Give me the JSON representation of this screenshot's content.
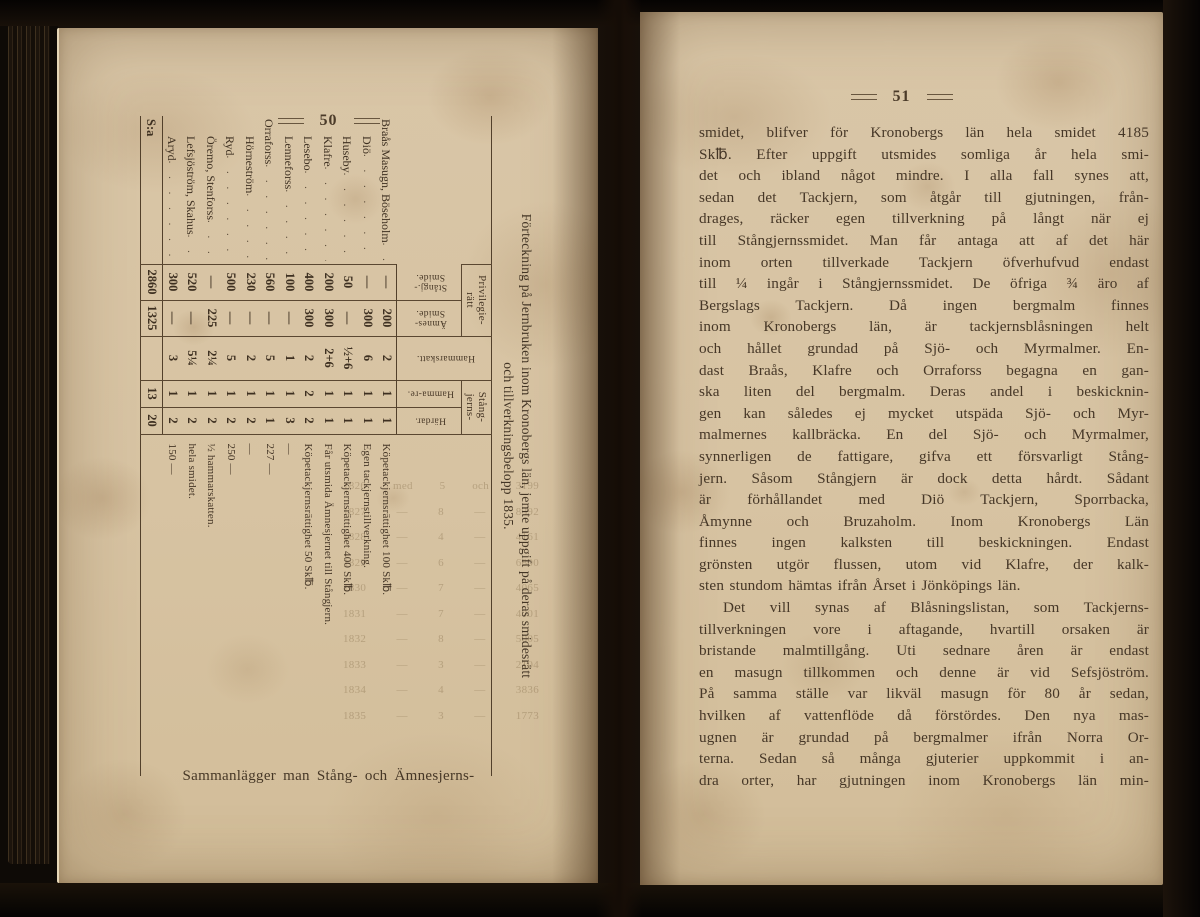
{
  "colors": {
    "paper": "#d8c5a4",
    "ink": "#463727",
    "background_dark": "#0d0906"
  },
  "left_page": {
    "page_number": "50",
    "table": {
      "title_line1": "Förteckning på Jernbruken inom Kronobergs län, jemte uppgift på deras smidesrätt",
      "title_line2": "och tillverkningsbelopp 1835.",
      "group_headers": {
        "privilegieratt": "Privilegie-rätt",
        "stangjerns": "Stång-jerns-"
      },
      "column_headers": {
        "stangj_smide": "Stångj.-Smide.",
        "amnes_smide": "Ämnes-Smide.",
        "hammarskatt": "Hammarskatt.",
        "hammare": "Hamma-re.",
        "hardar": "Härdar."
      },
      "rows": [
        {
          "name": "Braås Masugn, Böseholm",
          "indent": false,
          "stangj": "—",
          "amnes": "200",
          "skatt": "2",
          "hammare": "1",
          "hardar": "1",
          "note": "Köpetackjernsrättighet 100 Sk℔."
        },
        {
          "name": "Diö",
          "indent": true,
          "stangj": "—",
          "amnes": "300",
          "skatt": "6",
          "hammare": "1",
          "hardar": "1",
          "note": "Egen tackjernstillverkning."
        },
        {
          "name": "Huseby",
          "indent": true,
          "stangj": "50",
          "amnes": "—",
          "skatt": "½+6",
          "hammare": "1",
          "hardar": "1",
          "note": "Köpetackjernsrättighet 400 Sk℔."
        },
        {
          "name": "Klafre",
          "indent": true,
          "stangj": "200",
          "amnes": "300",
          "skatt": "2+6",
          "hammare": "1",
          "hardar": "1",
          "note": "Får utsmida Ämnesjernet till Stångjern."
        },
        {
          "name": "Lesebo",
          "indent": true,
          "stangj": "400",
          "amnes": "300",
          "skatt": "2",
          "hammare": "2",
          "hardar": "2",
          "note": "Köpetackjernsrättighet 50 Sk℔."
        },
        {
          "name": "Lenneforss",
          "indent": true,
          "stangj": "100",
          "amnes": "—",
          "skatt": "1",
          "hammare": "1",
          "hardar": "3",
          "note": "—"
        },
        {
          "name": "Orraforss",
          "indent": false,
          "stangj": "560",
          "amnes": "—",
          "skatt": "5",
          "hammare": "1",
          "hardar": "1",
          "note": "227 —"
        },
        {
          "name": "Hörneström",
          "indent": true,
          "stangj": "230",
          "amnes": "—",
          "skatt": "2",
          "hammare": "1",
          "hardar": "2",
          "note": "—"
        },
        {
          "name": "Ryd",
          "indent": true,
          "stangj": "500",
          "amnes": "—",
          "skatt": "5",
          "hammare": "1",
          "hardar": "2",
          "note": "250 —"
        },
        {
          "name": "Öremo, Stenforss",
          "indent": true,
          "stangj": "—",
          "amnes": "225",
          "skatt": "2¼",
          "hammare": "1",
          "hardar": "2",
          "note": "½ hammarskatten."
        },
        {
          "name": "Lefsjöström, Skahus",
          "indent": true,
          "stangj": "520",
          "amnes": "—",
          "skatt": "5¼",
          "hammare": "1",
          "hardar": "2",
          "note": "hela smidet."
        },
        {
          "name": "Aryd",
          "indent": true,
          "stangj": "300",
          "amnes": "—",
          "skatt": "3",
          "hammare": "1",
          "hardar": "2",
          "note": "150 —"
        },
        {
          "name": "S:a",
          "indent": false,
          "sum": true,
          "stangj": "2860",
          "amnes": "1325",
          "skatt": "",
          "hammare": "13",
          "hardar": "20",
          "note": ""
        }
      ]
    },
    "bleedthrough": [
      "1826 med 5 och 3199",
      "1827 — 8 — 8392",
      "1828 — 4 — 4161",
      "1829 — 6 — 6800",
      "1830 — 7 — 4065",
      "1831 — 7 — 4001",
      "1832 — 8 — 5005",
      "1833 — 3 — 2104",
      "1834 — 4 — 3836",
      "1835 — 3 — 1773"
    ],
    "caption": "Sammanlägger man Stång- och Ämnesjerns-"
  },
  "right_page": {
    "page_number": "51",
    "paragraph1_lines": [
      "smidet, blifver för Kronobergs län hela smidet 4185",
      "Sk℔. Efter uppgift utsmides somliga år hela smi-",
      "det och ibland något mindre. I alla fall synes att,",
      "sedan det Tackjern, som åtgår till gjutningen, från-",
      "drages, räcker egen tillverkning på långt när ej",
      "till Stångjernssmidet. Man får antaga att af det här",
      "inom orten tillverkade Tackjern öfverhufvud endast",
      "till ¼ ingår i Stångjernssmidet. De öfriga ¾ äro af",
      "Bergslags Tackjern. Då ingen bergmalm finnes",
      "inom Kronobergs län, är tackjernsblåsningen helt",
      "och hållet grundad på Sjö- och Myrmalmer. En-",
      "dast Braås, Klafre och Orraforss begagna en gan-",
      "ska liten del bergmalm. Deras andel i beskicknin-",
      "gen kan således ej mycket utspäda Sjö- och Myr-",
      "malmernes kallbräcka. En del Sjö- och Myrmalmer,",
      "synnerligen de fattigare, gifva ett försvarligt Stång-",
      "jern. Såsom Stångjern är dock detta hårdt. Sådant",
      "är förhållandet med Diö Tackjern, Sporrbacka,",
      "Åmynne och Bruzaholm. Inom Kronobergs Län",
      "finnes ingen kalksten till beskickningen. Endast",
      "grönsten utgör flussen, utom vid Klafre, der kalk-",
      "sten stundom hämtas ifrån Årset i Jönköpings län."
    ],
    "paragraph2_lines": [
      "Det vill synas af Blåsningslistan, som Tackjerns-",
      "tillverkningen vore i aftagande, hvartill orsaken är",
      "bristande malmtillgång. Uti sednare åren är endast",
      "en masugn tillkommen och denne är vid Sefsjöström.",
      "På samma ställe var likväl masugn för 80 år sedan,",
      "hvilken af vattenflöde då förstördes. Den nya mas-",
      "ugnen är grundad på bergmalmer ifrån Norra Or-",
      "terna. Sedan så många gjuterier uppkommit i an-",
      "dra orter, har gjutningen inom Kronobergs län min-"
    ]
  }
}
